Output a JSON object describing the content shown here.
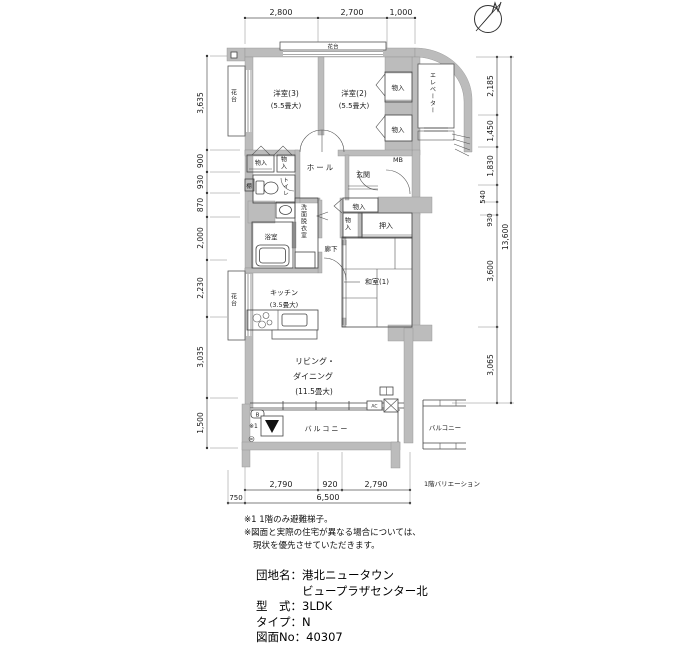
{
  "compass": {
    "north_label": "N"
  },
  "dims": {
    "top": [
      "2,800",
      "2,700",
      "1,000"
    ],
    "left": [
      "3,635",
      "900",
      "930",
      "870",
      "2,000",
      "2,230",
      "3,035",
      "1,500"
    ],
    "right": [
      "2,185",
      "1,450",
      "1,830",
      "540",
      "930",
      "3,600",
      "3,065"
    ],
    "right_total": "13,600",
    "bottom": [
      "2,790",
      "920",
      "2,790"
    ],
    "bottom_left": "750",
    "bottom_total": "6,500"
  },
  "labels": {
    "kadai": "花台",
    "yoshitsu3": "洋室(3)",
    "yoshitsu2": "洋室(2)",
    "size55": "(5.5畳大)",
    "monoiri": "物入",
    "elevator": "エレベーター",
    "hall": "ホール",
    "genkan": "玄関",
    "mb": "MB",
    "tana": "棚",
    "toilet": "トイレ",
    "senmen": "洗面脱衣室",
    "bath": "浴室",
    "laundry": "洗",
    "rouka": "廊下",
    "oshiire": "押入",
    "washitsu1": "和室(1)",
    "kitchen": "キッチン",
    "kitchen_size": "(3.5畳大)",
    "counter": "カウンター",
    "living1": "リビング・",
    "living2": "ダイニング",
    "living3": "(11.5畳大)",
    "balcony": "バルコニー",
    "b_mark": "B",
    "hatch_mark": "※1",
    "ac": "AC",
    "variation": "1階バリエーション"
  },
  "notes": {
    "line1": "※1 1階のみ避難梯子。",
    "line2": "※図面と実際の住宅が異なる場合については、",
    "line3": "現状を優先させていただきます。"
  },
  "info": {
    "danchi_label": "団地名：",
    "danchi_line1": "港北ニュータウン",
    "danchi_line2": "ビュープラザセンター北",
    "kata_label": "型　式：",
    "kata_value": "3LDK",
    "type_label": "タイプ：",
    "type_value": "N",
    "zumen_label": "図面No：",
    "zumen_value": "40307"
  }
}
